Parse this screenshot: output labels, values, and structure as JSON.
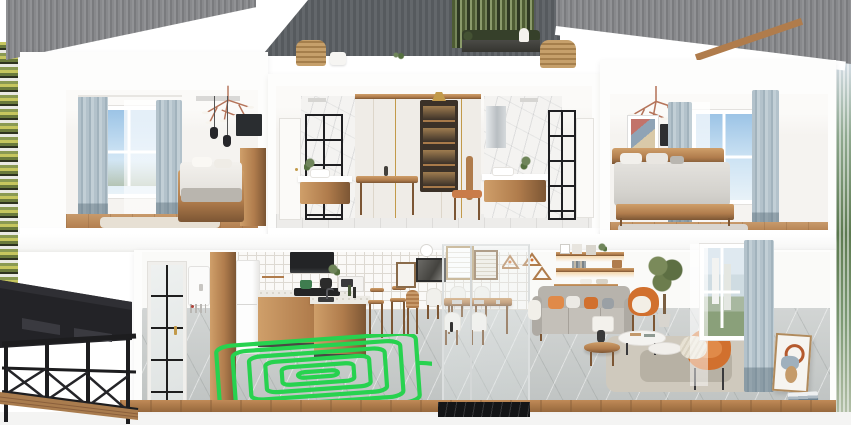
{
  "scene": {
    "type": "3d-cutaway-house-cross-section-render",
    "roof": [
      "gray-corrugated-roof-left",
      "dark-gray-center-wall",
      "gray-corrugated-roof-right"
    ],
    "roof_terrace": [
      "rattan-chair",
      "rattan-sofa",
      "white-table-lamp",
      "planter-hedge",
      "tall-green-plants",
      "small-plant"
    ],
    "upper_floor": {
      "left_bedroom": [
        "window-garden-view",
        "sheer-curtain",
        "blue-gray-curtains",
        "branch-chandelier",
        "two-black-pendant-lights",
        "wall-tv",
        "wood-bed-white-bedding",
        "wood-dresser",
        "beige-rug",
        "wood-floor"
      ],
      "center_bathroom_dressing": [
        "white-door",
        "marble-tile-walls",
        "black-framed-shower-glass",
        "floating-wood-vanity-with-sink",
        "potted-plants",
        "illuminated-shelf-niche",
        "brass-pendant",
        "wood-desk",
        "wood-chair-terracotta-seat",
        "silver-cabinet",
        "second-vanity-with-sink",
        "black-framed-glass-door",
        "ceiling-lights"
      ],
      "right_bedroom": [
        "branch-chandelier",
        "framed-art",
        "dark-wall-panel",
        "wood-bed-gray-bedding",
        "window-sky-view",
        "sheer-curtain",
        "blue-gray-curtains",
        "gray-rug",
        "wood-floor"
      ]
    },
    "lower_floor": {
      "exterior_left": [
        "black-steel-stair-canopy",
        "black-diamond-railing",
        "wood-deck-steps"
      ],
      "entry": [
        "black-grid-glass-door",
        "gold-door-handle",
        "wall-mounted-boiler",
        "wood-wall-panel"
      ],
      "kitchen": [
        "white-fridge",
        "grid-tile-backsplash",
        "open-wood-shelves",
        "black-range-hood",
        "gas-cooktop",
        "green-pot",
        "black-kettle",
        "microwave",
        "terrazzo-counters",
        "wood-base-cabinets",
        "island-with-sink-and-faucet",
        "two-wood-bar-stools"
      ],
      "kitchen_floor_highlight": "green-radiant-floor-heating-coil",
      "dining": [
        "gallery-wall-frames",
        "wall-clock",
        "wood-dining-table-with-placemats",
        "white-shell-chairs",
        "wood-chair",
        "geometric-triangle-wall-decor",
        "glass-partition",
        "black-marble-partition-base"
      ],
      "living": [
        "floating-wood-shelves-with-underlighting",
        "shelf-decor-frames-plants-boxes",
        "gray-sofa-with-orange-pillows",
        "white-arm-throw",
        "wood-round-side-table",
        "dark-vase",
        "white-table-lamp",
        "white-oval-nesting-coffee-tables",
        "orange-shell-chair-with-sheepskin",
        "orange-lounge-chair-with-knit-throw",
        "potted-tree",
        "beige-area-rug",
        "window-street-view",
        "sheer-curtain",
        "blue-gray-curtain",
        "leaning-abstract-canvas",
        "stacked-books"
      ]
    },
    "structure": [
      "white-floor-slab",
      "wood-cut-floor-edges",
      "white-foundation"
    ],
    "surroundings": [
      "blurred-foliage-strip-left",
      "blurred-foliage-strip-right"
    ]
  },
  "colors": {
    "roof-gray-a": "#919295",
    "roof-gray-b": "#7a7b7e",
    "center-wall-a": "#63676b",
    "center-wall-b": "#565a5e",
    "white-wall": "#fdfdfc",
    "interior-wall": "#f5f3f0",
    "wood": "#b07c4c",
    "wood-light": "#cf9f6a",
    "wood-dark": "#7c5634",
    "curtain-blue": "#b3c2cb",
    "curtain-blue-dark": "#8fa2ad",
    "sky-deep": "#9cc4e6",
    "sky-light": "#e8f2f8",
    "heating-coil-green": "#27d24f",
    "accent-orange": "#d1702e",
    "accent-orange-light": "#e08a49",
    "sofa-gray": "#b7b3ac",
    "tile-a": "#d2d5d4",
    "tile-b": "#c0c4c3",
    "marble": "#f4f3f1",
    "black-frame": "#1f1f22",
    "stair-black": "#232327",
    "partition-base": "#141517",
    "terrazzo": "#eceae4",
    "brass": "#c29a4a",
    "copper": "#b5745a",
    "foliage": "#5c7a50",
    "hedge": "#36402a",
    "rattan": "#c6a06b",
    "rug-beige": "#cfc9bd",
    "foundation": "#f4f4f3"
  }
}
